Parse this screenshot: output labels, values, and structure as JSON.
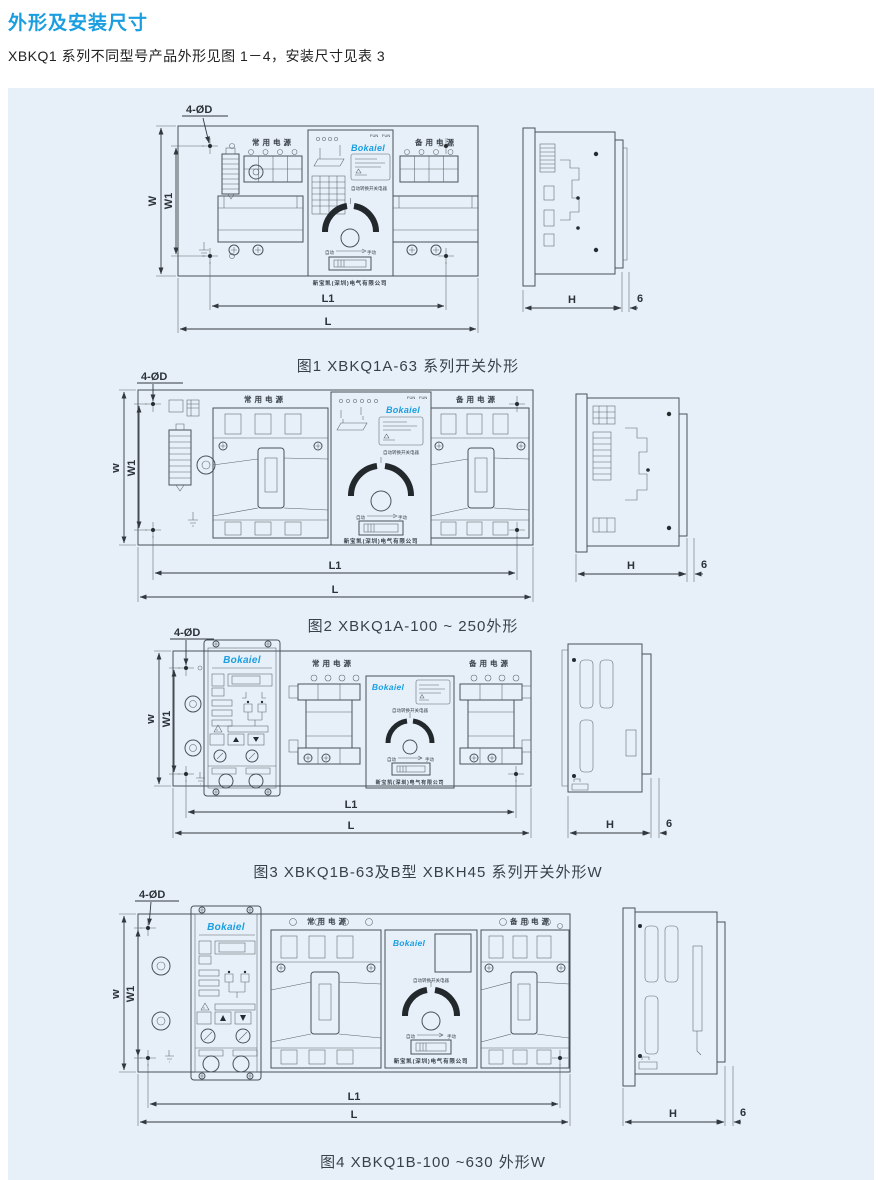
{
  "page": {
    "title": "外形及安装尺寸",
    "intro": "XBKQ1 系列不同型号产品外形见图 1－4，安装尺寸见表 3"
  },
  "colors": {
    "accent_blue": "#1a9ee0",
    "panel_background": "#e7f0f9",
    "drawing_line": "#4a5058"
  },
  "device": {
    "brand": "Bokaiel",
    "normal_power": "常用电源",
    "backup_power": "备用电源",
    "type_label": "自动转换开关电器",
    "company": "新宝凯(深圳)电气有限公司",
    "auto": "自动",
    "manual": "手动",
    "fun": "FUN"
  },
  "dims": {
    "hole": "4-ØD",
    "w": "W",
    "w1": "W1",
    "l1": "L1",
    "l": "L",
    "h": "H",
    "side_gap": "6"
  },
  "figures": [
    {
      "caption": "图1 XBKQ1A-63 系列开关外形"
    },
    {
      "caption": "图2 XBKQ1A-100 ~ 250外形"
    },
    {
      "caption": "图3 XBKQ1B-63及B型 XBKH45 系列开关外形W"
    },
    {
      "caption": "图4 XBKQ1B-100 ~630 外形W"
    }
  ]
}
